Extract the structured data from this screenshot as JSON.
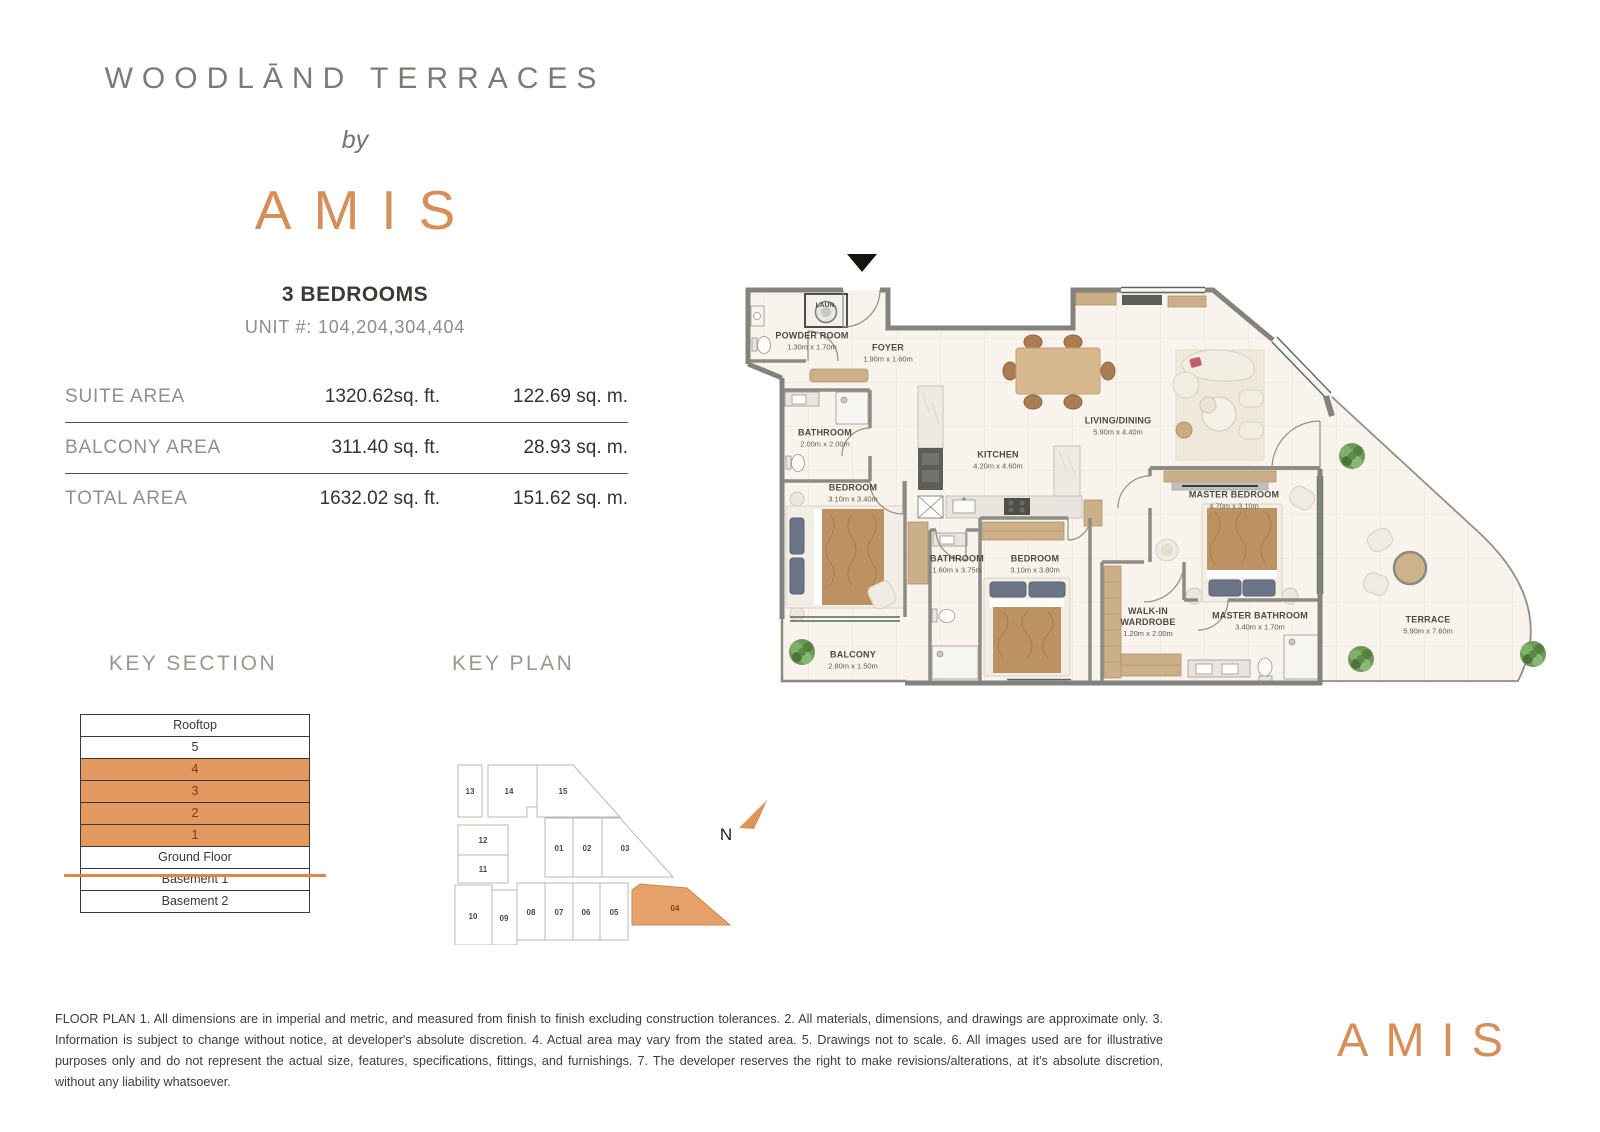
{
  "header": {
    "project": "WOODLĀND TERRACES",
    "by_label": "by",
    "brand": "AMIS",
    "unit_type": "3 BEDROOMS",
    "unit_numbers": "UNIT #: 104,204,304,404"
  },
  "areas": {
    "rows": [
      {
        "label": "SUITE AREA",
        "imperial": "1320.62sq. ft.",
        "metric": "122.69 sq. m."
      },
      {
        "label": "BALCONY AREA",
        "imperial": "311.40 sq. ft.",
        "metric": "28.93 sq. m."
      },
      {
        "label": "TOTAL AREA",
        "imperial": "1632.02 sq. ft.",
        "metric": "151.62 sq. m."
      }
    ]
  },
  "floor_plan": {
    "rooms": [
      {
        "name": "POWDER ROOM",
        "dims": "1.30m x 1.70m"
      },
      {
        "name": "FOYER",
        "dims": "1.90m x 1.60m"
      },
      {
        "name": "LAUN."
      },
      {
        "name": "BATHROOM",
        "dims": "2.00m x 2.00m"
      },
      {
        "name": "BEDROOM",
        "dims": "3.10m x 3.40m"
      },
      {
        "name": "KITCHEN",
        "dims": "4.20m x 4.60m"
      },
      {
        "name": "LIVING/DINING",
        "dims": "5.90m x 4.40m"
      },
      {
        "name": "MASTER BEDROOM",
        "dims": "4.70m x 3.10m"
      },
      {
        "name": "BATHROOM",
        "dims": "1.60m x 3.75m"
      },
      {
        "name": "BEDROOM",
        "dims": "3.10m x 3.80m"
      },
      {
        "name": "WALK-IN WARDROBE",
        "dims": "1.20m x 2.00m"
      },
      {
        "name": "MASTER BATHROOM",
        "dims": "3.40m x 1.70m"
      },
      {
        "name": "BALCONY",
        "dims": "2.80m x 1.50m"
      },
      {
        "name": "TERRACE",
        "dims": "5.90m x 7.60m"
      }
    ]
  },
  "key_section": {
    "title": "KEY SECTION",
    "floors": [
      {
        "label": "Rooftop",
        "highlight": false
      },
      {
        "label": "5",
        "highlight": false
      },
      {
        "label": "4",
        "highlight": true
      },
      {
        "label": "3",
        "highlight": true
      },
      {
        "label": "2",
        "highlight": true
      },
      {
        "label": "1",
        "highlight": true
      },
      {
        "label": "Ground Floor",
        "highlight": false
      },
      {
        "label": "Basement 1",
        "highlight": false
      },
      {
        "label": "Basement 2",
        "highlight": false
      }
    ]
  },
  "key_plan": {
    "title": "KEY PLAN",
    "north_label": "N",
    "units": [
      "13",
      "14",
      "15",
      "12",
      "11",
      "01",
      "02",
      "03",
      "10",
      "09",
      "08",
      "07",
      "06",
      "05",
      "04"
    ],
    "highlighted_unit": "04"
  },
  "footer": {
    "disclaimer": "FLOOR PLAN 1. All dimensions are in imperial and metric, and measured from finish to finish excluding construction tolerances. 2. All materials, dimensions, and drawings are approximate only. 3. Information is subject to change without notice, at developer's absolute discretion. 4. Actual area may vary from the stated area. 5. Drawings not to scale. 6. All images used are for illustrative purposes only and do not represent the actual size, features, specifications, fittings, and furnishings. 7. The developer reserves the right to make revisions/alterations, at it's absolute discretion, without any liability whatsoever.",
    "brand": "AMIS"
  },
  "colors": {
    "accent_orange": "#D78E58",
    "highlight_fill": "#E2985F",
    "highlight_line": "#E08748",
    "wall_gray": "#83837D",
    "floor_cream": "#F8F4ED"
  }
}
